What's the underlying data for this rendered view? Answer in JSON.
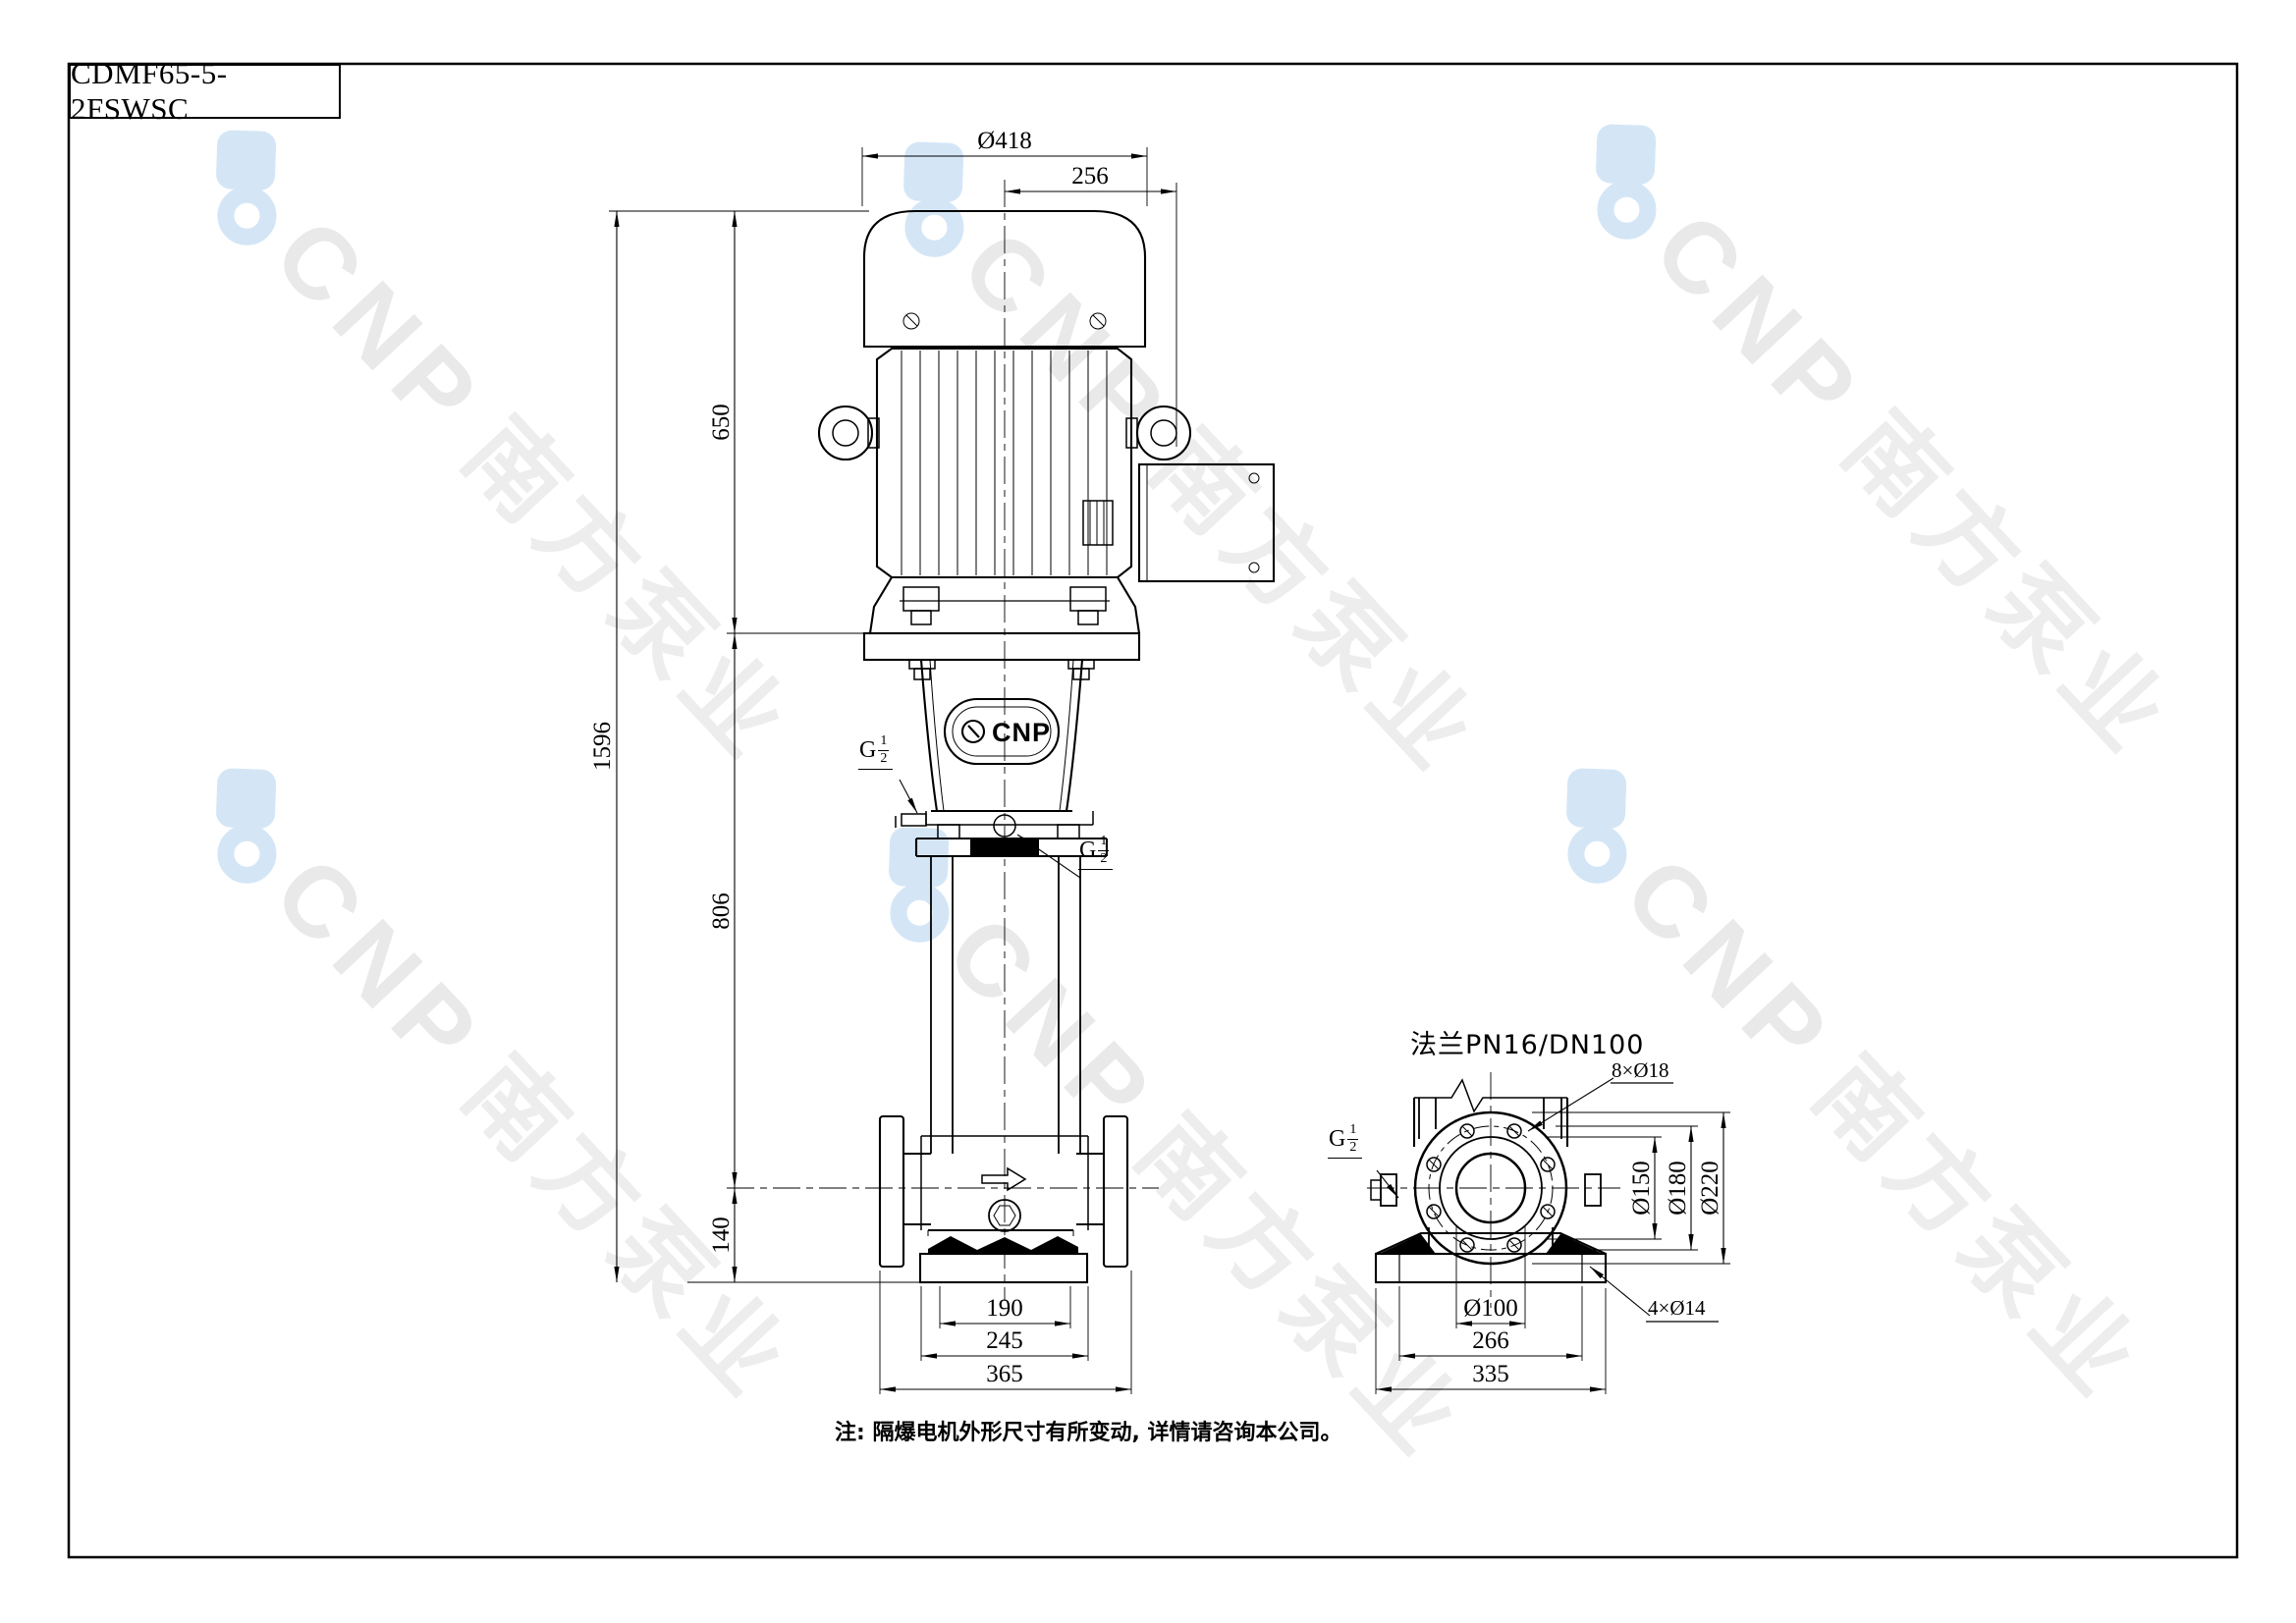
{
  "title_block": {
    "model": "CDMF65-5-2FSWSC"
  },
  "front_view": {
    "dims": {
      "motor_od": "Ø418",
      "terminal_offset": "256",
      "motor_height": "650",
      "total_height": "1596",
      "pump_height": "806",
      "port_height": "140",
      "base_inner_width": "190",
      "base_outer_width": "245",
      "flange_span": "365"
    },
    "badge_text": "CNP",
    "plugs": {
      "vent": {
        "prefix": "G",
        "num": "1",
        "den": "2"
      },
      "gauge": {
        "prefix": "G",
        "num": "1",
        "den": "2"
      }
    }
  },
  "side_view": {
    "flange_title": "法兰PN16/DN100",
    "dims": {
      "raised_face": "Ø150",
      "bolt_circle": "Ø180",
      "flange_od": "Ø220",
      "bore": "Ø100",
      "port_span": "266",
      "base_width": "335"
    },
    "callouts": {
      "bolt_holes": "8×Ø18",
      "foot_holes": "4×Ø14"
    },
    "plug": {
      "prefix": "G",
      "num": "1",
      "den": "2"
    }
  },
  "note": "注: 隔爆电机外形尺寸有所变动, 详情请咨询本公司。",
  "watermark": {
    "brand": "CNP",
    "company": "南方泵业",
    "logo_color": "#d4e6f6",
    "text_color": "#e9e9e9"
  }
}
